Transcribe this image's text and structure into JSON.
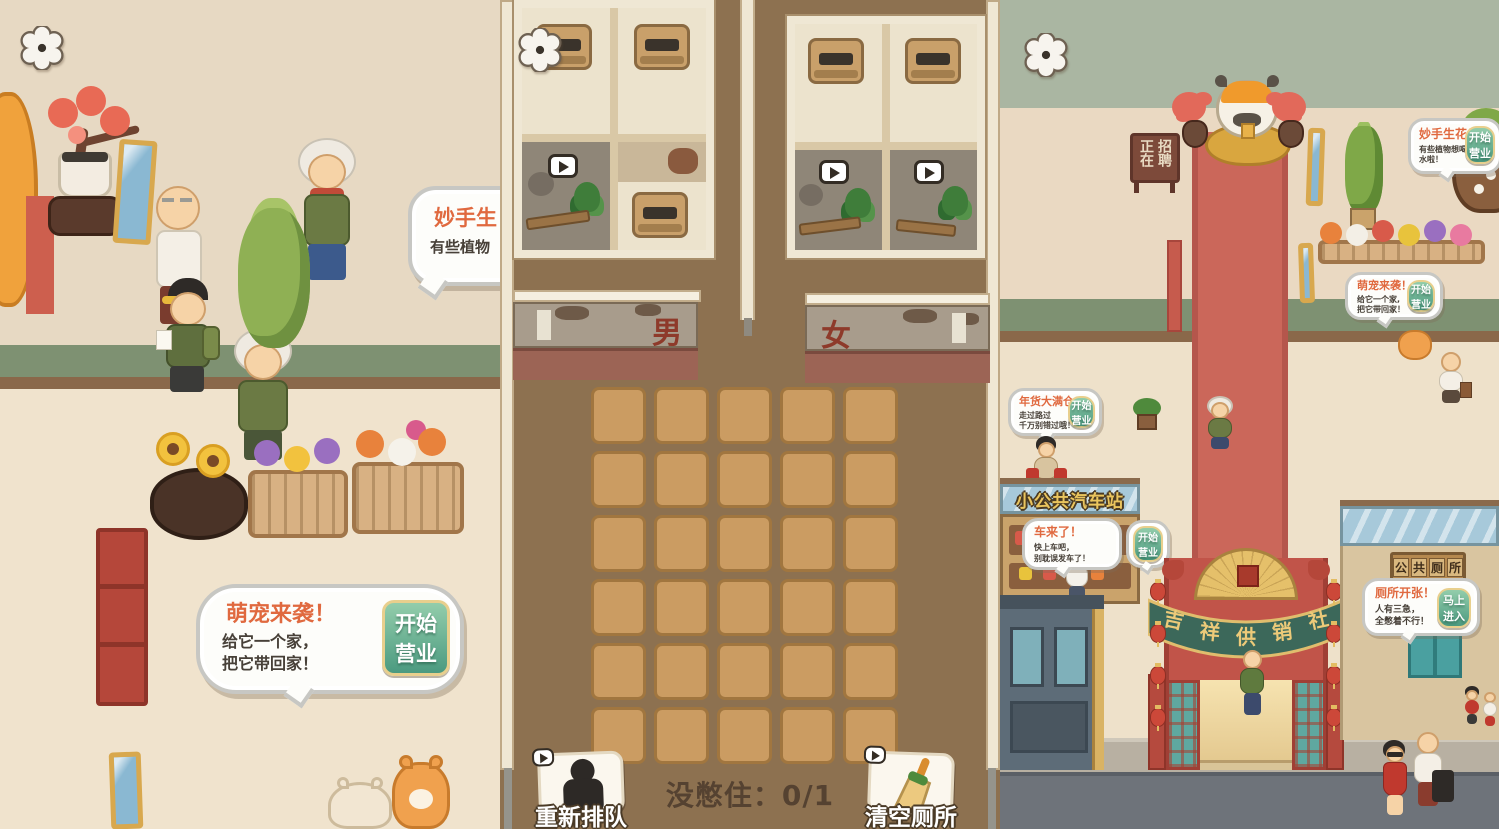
{
  "colors": {
    "accent_orange": "#e0693f",
    "button_green": "#4b9a80",
    "button_border_gold": "#e8cf8d",
    "carpet_red": "#cb675a",
    "banner_green": "#3c685a",
    "sign_gold": "#eac55e",
    "panel_brown": "#8d7150"
  },
  "left_panel": {
    "plant_bubble": {
      "title": "妙手生",
      "line1": "有些植物"
    },
    "pet_bubble": {
      "title": "萌宠来袭！",
      "line1": "给它一个家，",
      "line2": "把它带回家！",
      "button_line1": "开始",
      "button_line2": "营业"
    }
  },
  "middle_panel": {
    "men_sign": "男",
    "women_sign": "女",
    "status_text": "没憋住：0/1",
    "requeue_label": "重新排队",
    "clear_label": "清空厕所"
  },
  "right_panel": {
    "hiring_sign_col1": "正在",
    "hiring_sign_col2": "招聘",
    "plant_bubble": {
      "title": "妙手生花！",
      "line1": "有些植物想喝水啦！",
      "button_line1": "开始",
      "button_line2": "营业"
    },
    "pet_bubble": {
      "title": "萌宠来袭！",
      "line1": "给它一个家,",
      "line2": "把它带回家！",
      "button_line1": "开始",
      "button_line2": "营业"
    },
    "goods_bubble": {
      "title": "年货大满仓！",
      "line1": "走过路过",
      "line2": "千万别错过哦！",
      "button_line1": "开始",
      "button_line2": "营业"
    },
    "bus_bubble": {
      "title": "车来了！",
      "line1": "快上车吧，",
      "line2": "别耽误发车了！",
      "button_line1": "开始",
      "button_line2": "营业"
    },
    "toilet_bubble": {
      "title": "厕所开张！",
      "line1": "人有三急，",
      "line2": "全憋着不行！",
      "button_line1": "马上",
      "button_line2": "进入"
    },
    "bus_station_sign": "小公共汽车站",
    "arch_chars": [
      "吉",
      "祥",
      "供",
      "销",
      "社"
    ],
    "toilet_sign_chars": [
      "公",
      "共",
      "厕",
      "所"
    ]
  }
}
